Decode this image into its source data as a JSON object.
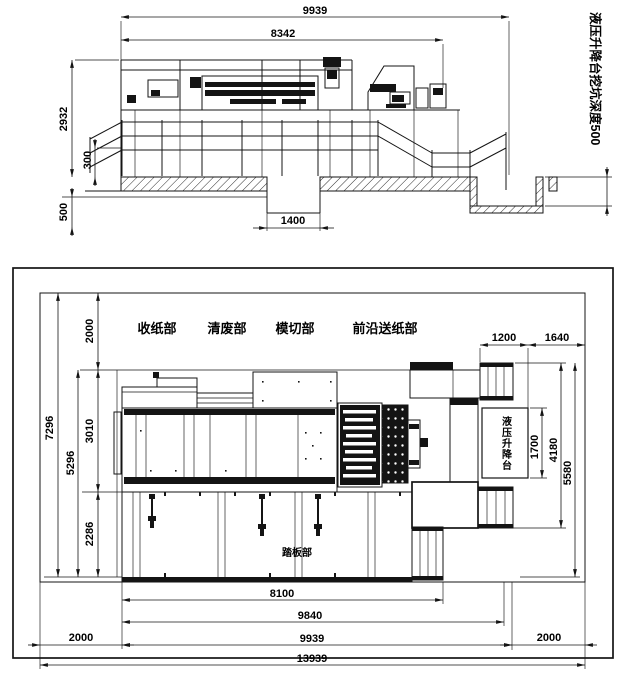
{
  "drawing": {
    "elevation": {
      "dim_total_width": "9939",
      "dim_machine_width": "8342",
      "dim_machine_height": "2932",
      "dim_fence_height": "300",
      "dim_pit_depth": "500",
      "dim_pit_width": "1400",
      "note_pit": "液压升降台挖坑深度500"
    },
    "plan": {
      "label_collect": "收纸部",
      "label_stripping": "清废部",
      "label_diecut": "模切部",
      "label_feeder": "前沿送纸部",
      "label_footboard": "踏板部",
      "label_lift": "液压升降台",
      "dim_top_clear": "2000",
      "dim_depth_total": "7296",
      "dim_depth_machine": "5296",
      "dim_depth_conveyor": "3010",
      "dim_depth_footboard": "2286",
      "dim_lift_w1": "1200",
      "dim_lift_w2": "1640",
      "dim_lift_len": "1700",
      "dim_feed_len": "4180",
      "dim_right_depth": "5580",
      "dim_len_footboard": "8100",
      "dim_len_9840": "9840",
      "dim_len_total": "9939",
      "dim_len_room": "13939",
      "dim_left_clear": "2000",
      "dim_right_clear": "2000"
    }
  }
}
